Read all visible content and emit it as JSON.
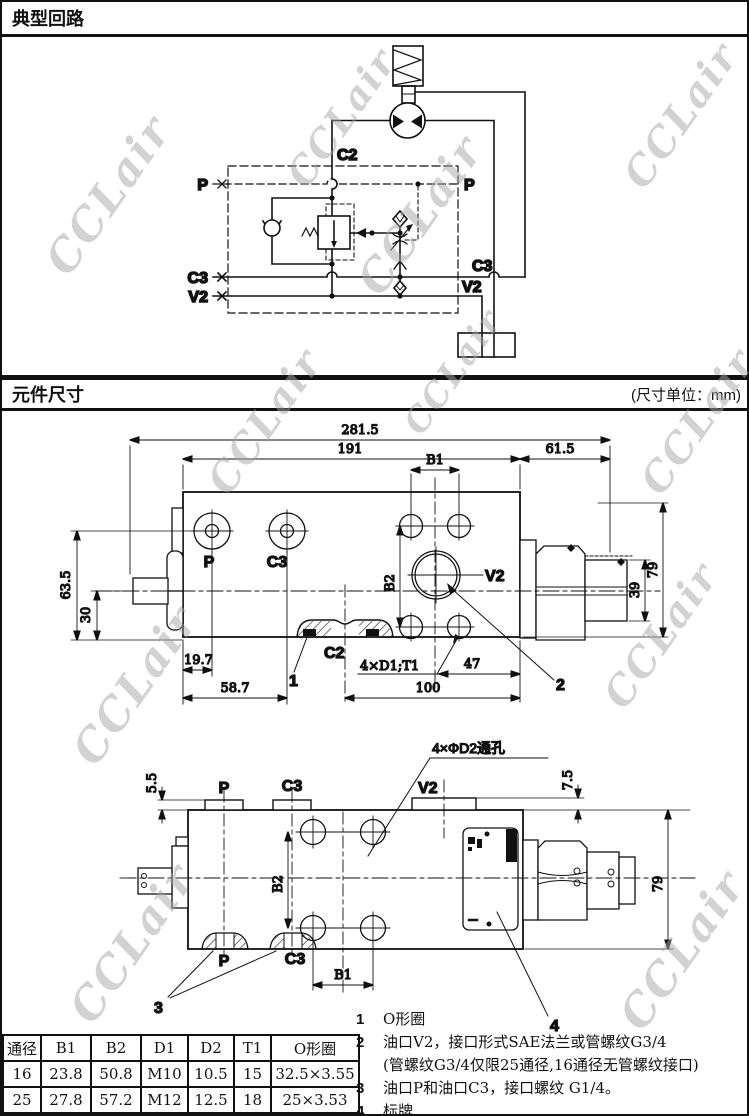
{
  "watermark": "CCLair",
  "page": {
    "header_top": "典型回路",
    "header_mid": {
      "title": "元件尺寸",
      "unit": "(尺寸单位：mm)"
    }
  },
  "circuit": {
    "c2": "C2",
    "p_left": "P",
    "p_right": "P",
    "c3_left": "C3",
    "c3_right": "C3",
    "v2_left": "V2",
    "v2_right": "V2"
  },
  "top_view": {
    "dim_total": "281.5",
    "dim_body": "191",
    "dim_cartridge": "61.5",
    "dim_b1": "B1",
    "dim_b2": "B2",
    "dim_63_5": "63.5",
    "dim_30": "30",
    "dim_79": "79",
    "dim_39": "39",
    "dim_19_7": "19.7",
    "dim_58_7": "58.7",
    "dim_holes": "4×D1;T1",
    "dim_47": "47",
    "dim_100": "100",
    "port_p": "P",
    "port_c3": "C3",
    "port_c2": "C2",
    "port_v2": "V2",
    "leader_1": "1",
    "leader_2": "2"
  },
  "front_view": {
    "dim_5_5": "5.5",
    "dim_7_5": "7.5",
    "dim_79": "79",
    "dim_b1": "B1",
    "dim_b2": "B2",
    "holes_label": "4×ΦD2通孔",
    "port_p_top": "P",
    "port_c3_top": "C3",
    "port_v2": "V2",
    "port_p_bottom": "P",
    "port_c3_bottom": "C3",
    "leader_3": "3",
    "leader_4": "4"
  },
  "spec_table": {
    "headers": [
      "通径",
      "B1",
      "B2",
      "D1",
      "D2",
      "T1",
      "O形圈"
    ],
    "rows": [
      [
        "16",
        "23.8",
        "50.8",
        "M10",
        "10.5",
        "15",
        "32.5×3.55"
      ],
      [
        "25",
        "27.8",
        "57.2",
        "M12",
        "12.5",
        "18",
        "25×3.53"
      ]
    ]
  },
  "notes": {
    "n1": {
      "num": "1",
      "text": "O形圈"
    },
    "n2": {
      "num": "2",
      "text": "油口V2，接口形式SAE法兰或管螺纹G3/4",
      "text2": "(管螺纹G3/4仅限25通径,16通径无管螺纹接口)"
    },
    "n3": {
      "num": "3",
      "text": "油口P和油口C3，接口螺纹 G1/4。"
    },
    "n4": {
      "num": "4",
      "text": "标牌"
    }
  },
  "colors": {
    "line": "#111111",
    "watermark_gray": "#a5a5a5"
  }
}
